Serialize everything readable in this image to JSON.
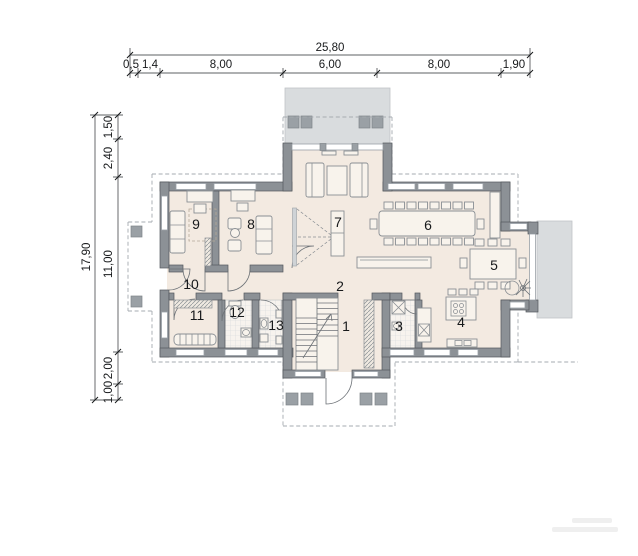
{
  "dimensions": {
    "top": {
      "total": "25,80",
      "segments": [
        "0,5",
        "1,4",
        "8,00",
        "6,00",
        "8,00",
        "1,90"
      ]
    },
    "left": {
      "total": "17,90",
      "segments": [
        "1,50",
        "2,40",
        "11,00",
        "2,00",
        "1,00"
      ]
    }
  },
  "rooms": [
    {
      "number": "1"
    },
    {
      "number": "2"
    },
    {
      "number": "3"
    },
    {
      "number": "4"
    },
    {
      "number": "5"
    },
    {
      "number": "6"
    },
    {
      "number": "7"
    },
    {
      "number": "8"
    },
    {
      "number": "9"
    },
    {
      "number": "10"
    },
    {
      "number": "11"
    },
    {
      "number": "12"
    },
    {
      "number": "13"
    }
  ],
  "colors": {
    "wall": "#8c9196",
    "floor": "#f3eae1",
    "terrace": "#d9dcde",
    "dashed_overhang": "#a6abb0",
    "dimension_text": "#17191b"
  }
}
